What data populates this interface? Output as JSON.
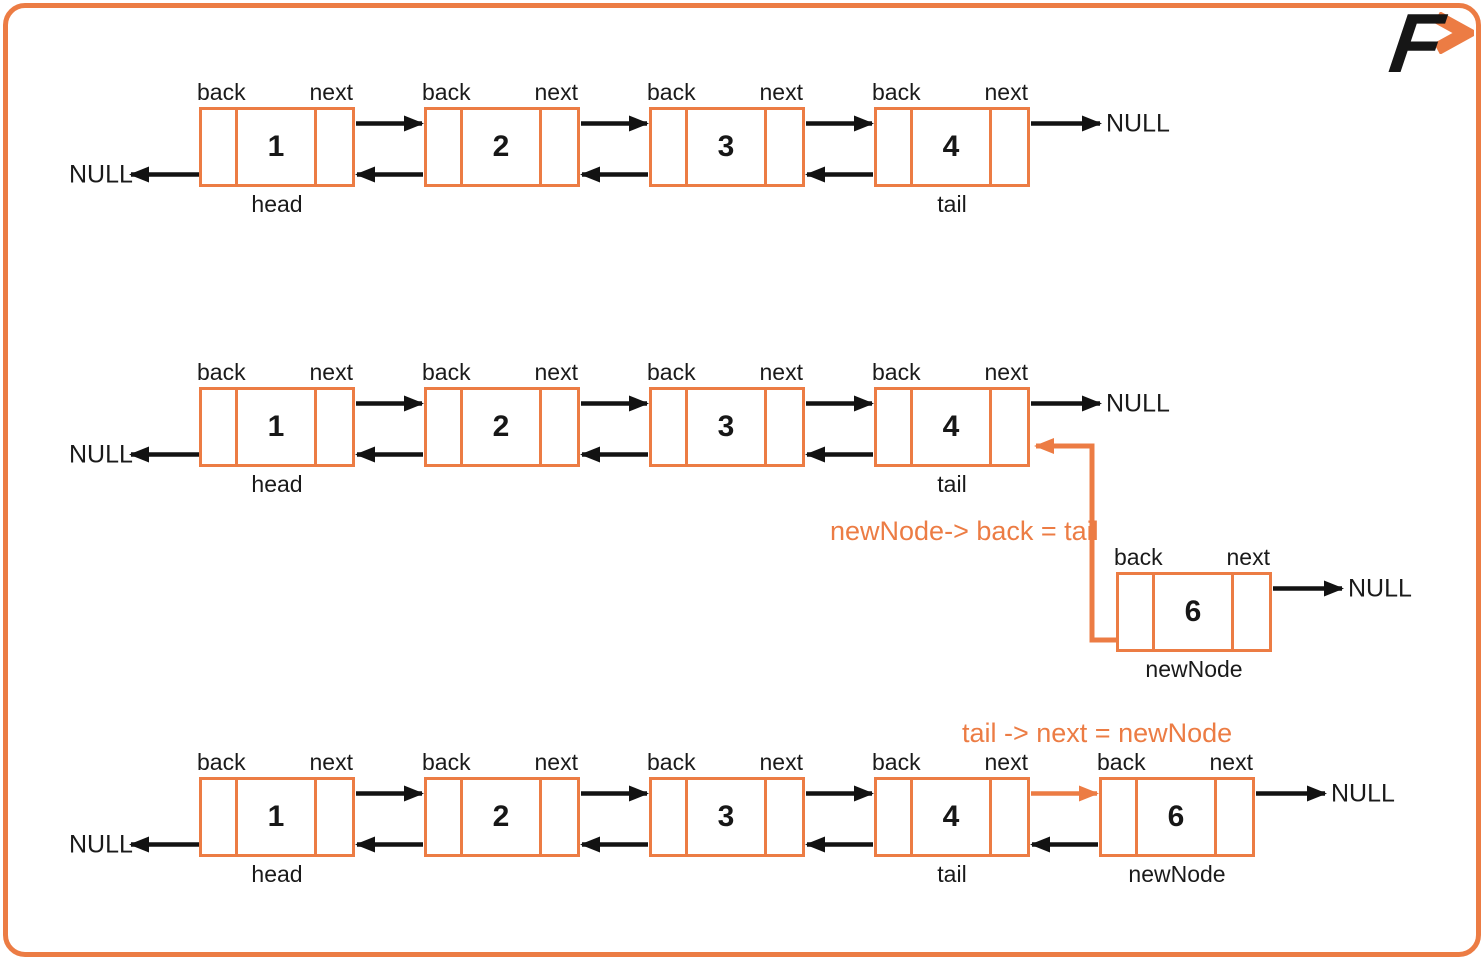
{
  "logo": {
    "letter": "F"
  },
  "colors": {
    "orange": "#EC7C44",
    "black": "#1A1A1A"
  },
  "labels": {
    "back": "back",
    "next": "next",
    "null": "NULL"
  },
  "annotations": {
    "assign_back": "newNode-> back = tail",
    "assign_next": "tail -> next = newNode"
  },
  "diagram": {
    "rows": [
      {
        "name": "doubly-linked-list-initial",
        "nodes": [
          {
            "value": "1",
            "below": "head"
          },
          {
            "value": "2"
          },
          {
            "value": "3"
          },
          {
            "value": "4",
            "below": "tail"
          }
        ]
      },
      {
        "name": "doubly-linked-list-before-link",
        "nodes": [
          {
            "value": "1",
            "below": "head"
          },
          {
            "value": "2"
          },
          {
            "value": "3"
          },
          {
            "value": "4",
            "below": "tail"
          }
        ]
      },
      {
        "name": "new-node",
        "nodes": [
          {
            "value": "6",
            "below": "newNode"
          }
        ]
      },
      {
        "name": "doubly-linked-list-final",
        "nodes": [
          {
            "value": "1",
            "below": "head"
          },
          {
            "value": "2"
          },
          {
            "value": "3"
          },
          {
            "value": "4",
            "below": "tail"
          },
          {
            "value": "6",
            "below": "newNode"
          }
        ]
      }
    ]
  }
}
